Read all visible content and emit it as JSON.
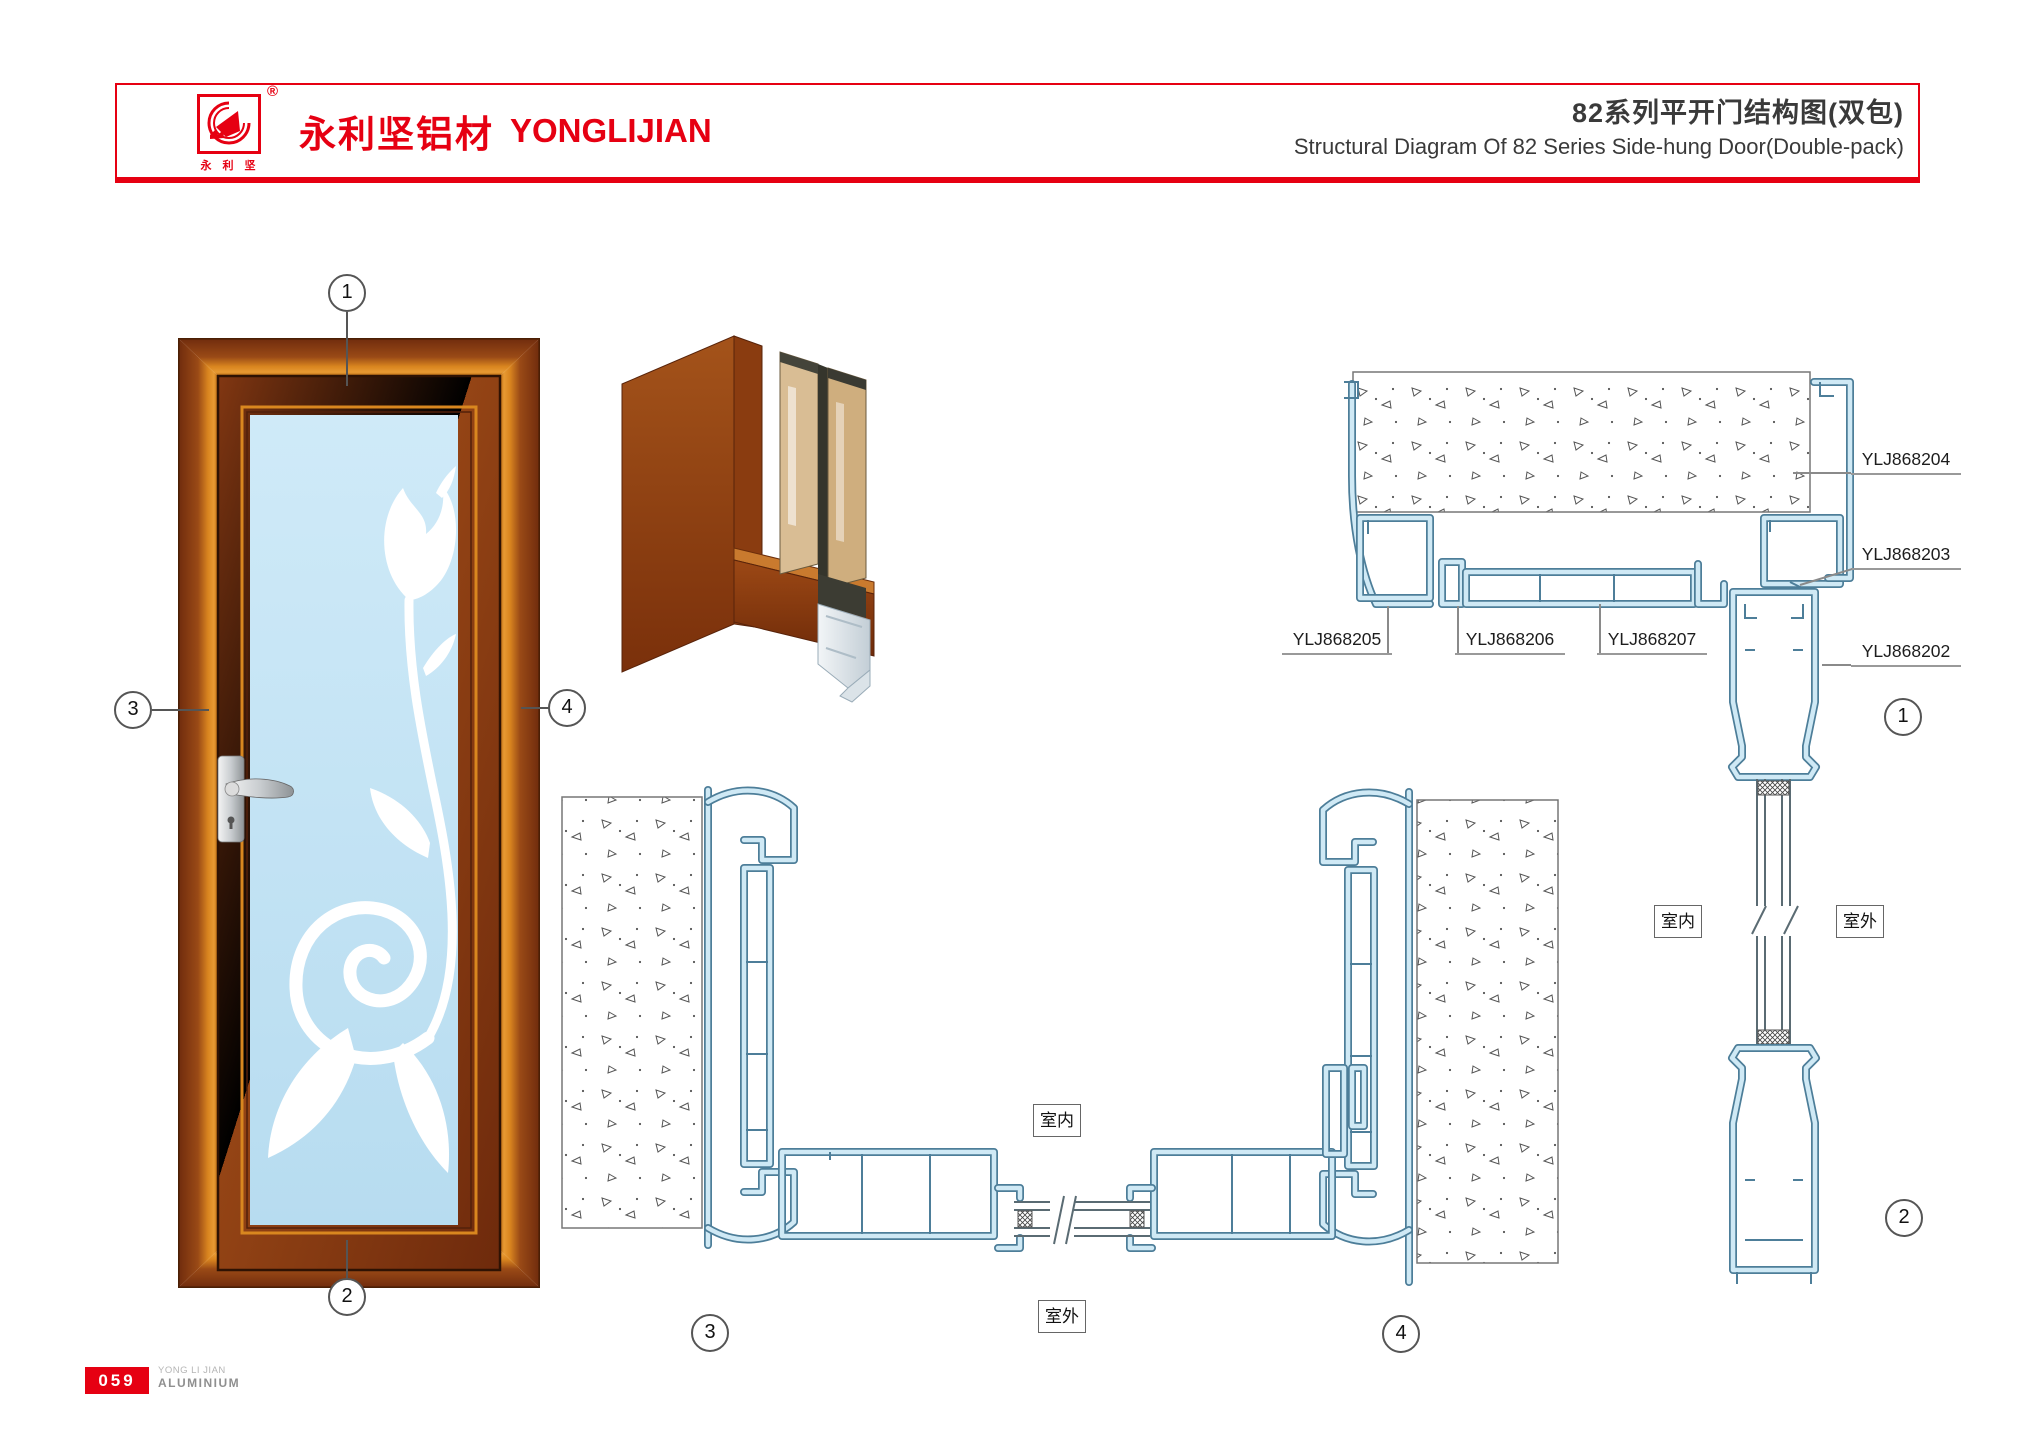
{
  "header": {
    "logo_chars": "永 利 坚",
    "registered": "®",
    "brand_cn": "永利坚铝材",
    "brand_en": "YONGLIJIAN",
    "title_cn": "82系列平开门结构图(双包)",
    "title_en": "Structural Diagram Of 82 Series Side-hung Door(Double-pack)"
  },
  "parts": {
    "p202": "YLJ868202",
    "p203": "YLJ868203",
    "p204": "YLJ868204",
    "p205": "YLJ868205",
    "p206": "YLJ868206",
    "p207": "YLJ868207"
  },
  "rooms": {
    "indoor": "室内",
    "outdoor": "室外"
  },
  "callouts": {
    "n1": "1",
    "n2": "2",
    "n3": "3",
    "n4": "4"
  },
  "footer": {
    "page": "059",
    "line1": "YONG LI JIAN",
    "line2": "ALUMINIUM"
  },
  "colors": {
    "accent": "#e60012",
    "profile_stroke": "#4d7e99",
    "profile_fill": "#cfe9f5",
    "glass": "#c4e4f6",
    "wood_dark": "#7a3110",
    "wood_light": "#d9851f"
  }
}
